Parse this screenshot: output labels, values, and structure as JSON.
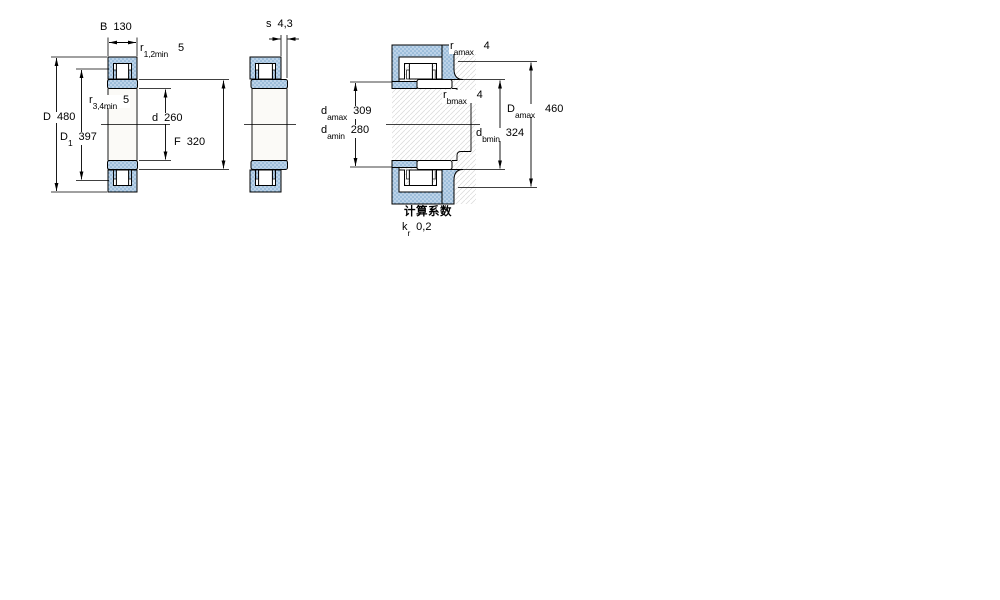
{
  "figure": {
    "type": "bearing-technical-drawing",
    "views": 3
  },
  "colors": {
    "steel_fill": "#bcd3e9",
    "steel_dot": "#7aa6ca",
    "hatch_line": "#d8d8d8",
    "line": "#000000",
    "background": "#ffffff"
  },
  "labels": {
    "B": {
      "base": "B",
      "sub": "",
      "value": "130"
    },
    "r12min": {
      "base": "r",
      "sub": "1,2min",
      "value": "5"
    },
    "D": {
      "base": "D",
      "sub": "",
      "value": "480"
    },
    "D1": {
      "base": "D",
      "sub": "1",
      "value": "397"
    },
    "r34min": {
      "base": "r",
      "sub": "3,4min",
      "value": "5"
    },
    "d": {
      "base": "d",
      "sub": "",
      "value": "260"
    },
    "F": {
      "base": "F",
      "sub": "",
      "value": "320"
    },
    "s": {
      "base": "s",
      "sub": "",
      "value": "4,3"
    },
    "ra_max": {
      "base": "r",
      "sub": "amax",
      "value": "4"
    },
    "rb_max": {
      "base": "r",
      "sub": "bmax",
      "value": "4"
    },
    "da_max": {
      "base": "d",
      "sub": "amax",
      "value": "309"
    },
    "da_min": {
      "base": "d",
      "sub": "amin",
      "value": "280"
    },
    "Da_max": {
      "base": "D",
      "sub": "amax",
      "value": "460"
    },
    "db_min": {
      "base": "d",
      "sub": "bmin",
      "value": "324"
    },
    "kr": {
      "base": "k",
      "sub": "r",
      "value": "0,2"
    }
  },
  "calculation": {
    "heading": "计算系数"
  }
}
